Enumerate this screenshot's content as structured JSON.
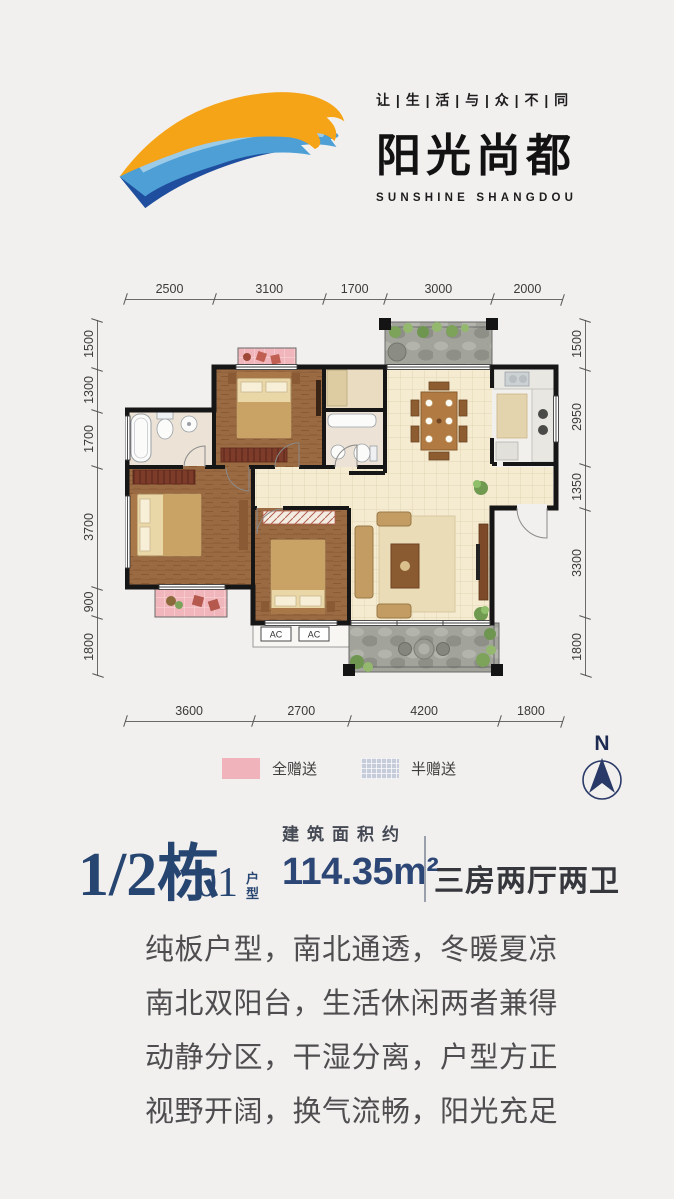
{
  "logo": {
    "tagline": "让 | 生 | 活 | 与 | 众 | 不 | 同",
    "brand": "阳光尚都",
    "brand_en": "SUNSHINE SHANGDOU",
    "colors": {
      "orange": "#F5A317",
      "blue_light": "#5FAEDC",
      "blue_dark": "#1E4E9D"
    }
  },
  "plan": {
    "dims": {
      "top": [
        "2500",
        "3100",
        "1700",
        "3000",
        "2000"
      ],
      "bottom": [
        "3600",
        "2700",
        "4200",
        "1800"
      ],
      "left": [
        "1500",
        "1300",
        "1700",
        "3700",
        "900",
        "1800"
      ],
      "right": [
        "1500",
        "2950",
        "1350",
        "3300",
        "1800"
      ]
    },
    "ac_label": "AC",
    "legend": [
      {
        "label": "全赠送",
        "color": "#F0B3BB"
      },
      {
        "label": "半赠送",
        "color": "#C7CCDA"
      }
    ],
    "compass_label": "N",
    "compass_color": "#2A3A68"
  },
  "info": {
    "block": "1/2栋",
    "unit_no": "01",
    "unit_suffix": "户型",
    "area_label": "建筑面积约",
    "area_value": "114.35m²",
    "layout": "三房两厅两卫",
    "accent_navy": "#274571"
  },
  "description": [
    "纯板户型，南北通透，冬暖夏凉",
    "南北双阳台，生活休闲两者兼得",
    "动静分区，干湿分离，户型方正",
    "视野开阔，换气流畅，阳光充足"
  ]
}
